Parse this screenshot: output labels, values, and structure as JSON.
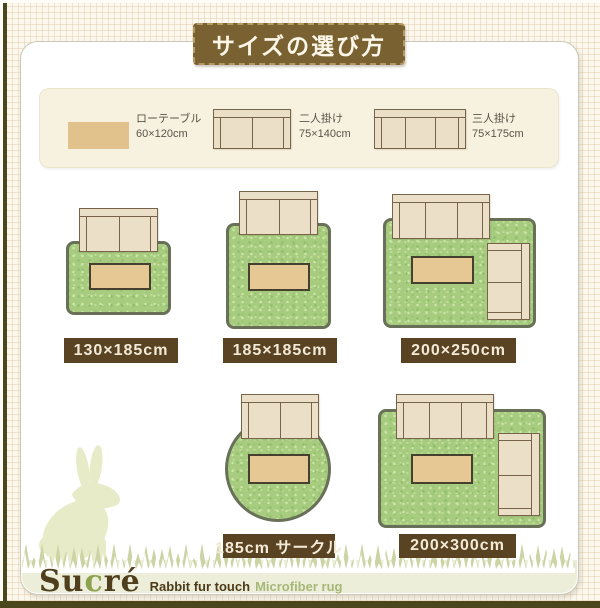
{
  "title": "サイズの選び方",
  "legend": {
    "items": [
      {
        "name": "low-table",
        "label": "ローテーブル",
        "size": "60×120cm"
      },
      {
        "name": "sofa-2seat",
        "label": "二人掛け",
        "size": "75×140cm"
      },
      {
        "name": "sofa-3seat",
        "label": "三人掛け",
        "size": "75×175cm"
      }
    ]
  },
  "layouts": [
    {
      "name": "rug-130x185",
      "label": "130×185cm",
      "shape": "rectangle",
      "furniture": [
        "sofa-2seat",
        "low-table"
      ]
    },
    {
      "name": "rug-185x185",
      "label": "185×185cm",
      "shape": "rectangle",
      "furniture": [
        "sofa-2seat",
        "low-table"
      ]
    },
    {
      "name": "rug-200x250",
      "label": "200×250cm",
      "shape": "rectangle",
      "furniture": [
        "sofa-3seat",
        "sofa-2seat",
        "low-table"
      ]
    },
    {
      "name": "rug-185-circle",
      "label": "185cm サークル",
      "shape": "circle",
      "furniture": [
        "sofa-2seat",
        "low-table"
      ]
    },
    {
      "name": "rug-200x300",
      "label": "200×300cm",
      "shape": "rectangle",
      "furniture": [
        "sofa-3seat",
        "sofa-2seat",
        "low-table"
      ]
    }
  ],
  "brand": {
    "name_prefix": "Su",
    "name_accent": "c",
    "name_suffix": "ré",
    "tagline_bold": "Rabbit fur touch",
    "tagline_light": "Microfiber rug"
  },
  "colors": {
    "badge_brown": "#7a6131",
    "label_bar_brown": "#5a4323",
    "rug_green": "#a7cc80",
    "rug_border": "#687058",
    "sofa_fill": "#ecdfc8",
    "sofa_line": "#75634a",
    "table_fill": "#e5c893",
    "logo_brown": "#4f3f1d",
    "logo_accent_green": "#8ca24e",
    "frame_olive": "#4b471d"
  }
}
